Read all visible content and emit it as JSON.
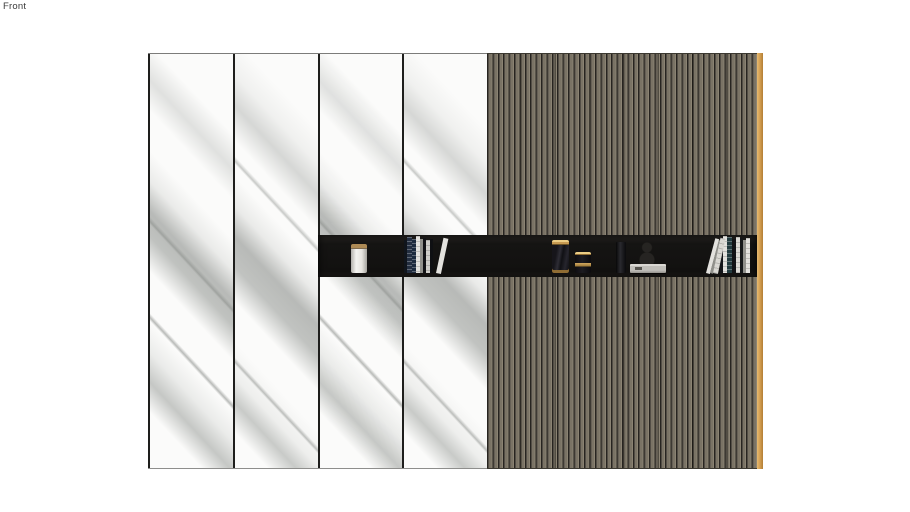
{
  "app": {
    "viewport_label": "Front"
  },
  "colors": {
    "background": "#ffffff",
    "label": "#3a3a3a",
    "marble_base": "#fbfbfa",
    "panel_divider": "#1e1e1c",
    "slat_face": "#7a7365",
    "slat_highlight": "#8b8373",
    "slat_shadow": "#534e46",
    "slat_groove": "#272420",
    "edge_strip_light": "#e8ba70",
    "edge_strip_mid": "#d09b4e",
    "edge_strip_dark": "#b37f35",
    "niche_bg": "#151413",
    "niche_top": "#272522",
    "gold": "#c79a52",
    "canister_lid": "#ad8a55",
    "book_navy_dark": "#10151c",
    "book_navy": "#232e40",
    "book_navy_mid": "#1c2a3d",
    "book_white": "#e3e2de",
    "book_gray": "#90908b",
    "book_black": "#121316",
    "book_teal": "#223a3e",
    "box_gray": "#c0beb9",
    "bottle_black": "#070708",
    "sculpture": "#2a2825"
  },
  "wall": {
    "marble_panel_count": 4,
    "sections": [
      "marble-panel-group",
      "wood-slat-panel",
      "wood-edge-strip",
      "display-niche"
    ],
    "niche_items": [
      {
        "name": "white-canister"
      },
      {
        "name": "book-stack-left"
      },
      {
        "name": "tall-gold-trim-canister"
      },
      {
        "name": "short-gold-trim-canister"
      },
      {
        "name": "dark-bottle"
      },
      {
        "name": "sculpture-silhouette"
      },
      {
        "name": "gray-tray"
      },
      {
        "name": "book-stack-right"
      }
    ]
  }
}
